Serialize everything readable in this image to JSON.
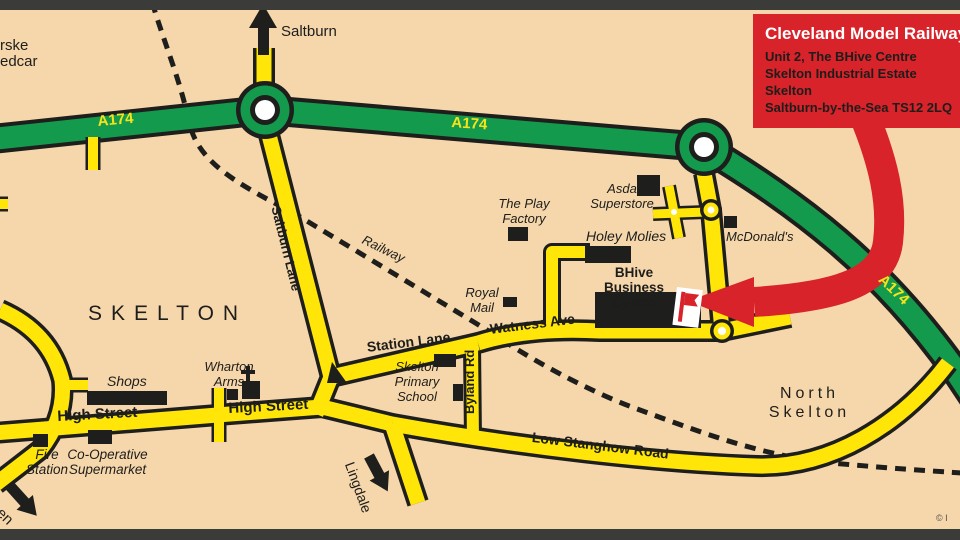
{
  "colors": {
    "background": "#f6d7ab",
    "road_yellow": "#ffe608",
    "road_green": "#149a4c",
    "outline_black": "#1e1e1c",
    "callout_red": "#d8232b",
    "frame_bar": "#3b3b39",
    "label_black": "#1d1d1b",
    "white": "#ffffff"
  },
  "callout": {
    "title": "Cleveland Model Railway Club",
    "lines": [
      "Unit 2, The BHive Centre",
      "Skelton Industrial Estate",
      "Skelton",
      "Saltburn-by-the-Sea TS12 2LQ"
    ]
  },
  "edge_labels": {
    "marske_fragment_top": "rske",
    "marske_fragment_bottom": "edcar",
    "saltburn_destination": "Saltburn",
    "green_destination": "Green",
    "lingdale_destination": "Lingdale",
    "copyright": "© I"
  },
  "areas": {
    "skelton": "SKELTON",
    "north_skelton": [
      "North",
      "Skelton"
    ]
  },
  "roads": {
    "a174": "A174",
    "saltburn_lane": "Saltburn Lane",
    "station_lane": "Station Lane",
    "watness_ave": "Watness Ave",
    "byland_rd": "Byland Rd",
    "high_street": "High Street",
    "low_stanghow_road": "Low Stanghow Road",
    "railway": "Railway"
  },
  "pois": {
    "asda": [
      "Asda",
      "Superstore"
    ],
    "play_factory": [
      "The Play",
      "Factory"
    ],
    "holey_molies": "Holey Molies",
    "mcdonalds": "McDonald's",
    "royal_mail": [
      "Royal",
      "Mail"
    ],
    "bhive": [
      "BHive Business",
      "Centre"
    ],
    "shops": "Shops",
    "wharton_arms": [
      "Wharton",
      "Arms"
    ],
    "fire_station": [
      "Fire",
      "Station"
    ],
    "co_op": [
      "Co-Operative",
      "Supermarket"
    ],
    "school": [
      "Skelton",
      "Primary",
      "School"
    ]
  }
}
